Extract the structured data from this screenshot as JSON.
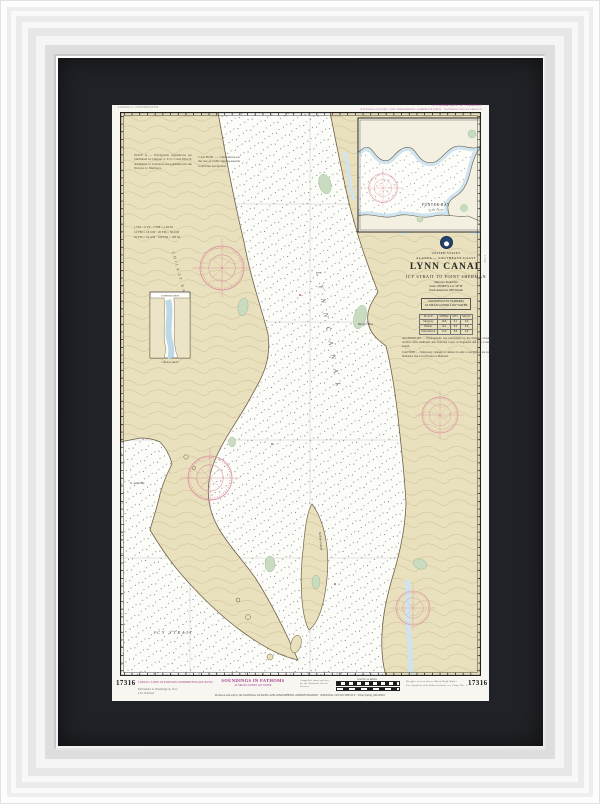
{
  "artwork": {
    "kind": "Framed NOAA nautical chart",
    "colors": {
      "mat": "#212227",
      "paper": "#f7f6f0",
      "land": "#e9e0bd",
      "water": "#fcfcf9",
      "shore_green": "#c9dcc0",
      "glacier_blue": "#cfe4ee",
      "compass_rose_pink": "#d9919f",
      "magenta": "#a7398f"
    }
  },
  "margins": {
    "top_left_note": "LORAN-C OVERPRINTED",
    "top_right_line1": "U.S. DEPARTMENT OF COMMERCE",
    "top_right_line2": "NATIONAL OCEANIC AND ATMOSPHERIC ADMINISTRATION · NATIONAL OCEAN SERVICE",
    "chart_number_left": "17316",
    "chart_number_right": "17316",
    "side_number": "17316",
    "bottom_left_magenta": "LORAN-C LINES OF POSITION OVERPRINTED (SEE NOTE)",
    "bottom_left_sub1": "Published at Washington, D.C.",
    "bottom_left_sub2": "21st Edition",
    "soundings_label": "SOUNDINGS IN FATHOMS",
    "soundings_sub": "AT MEAN LOWER LOW WATER",
    "production_cluster": "Compiled from surveys by the National Ocean Service",
    "scale_caption": "NAUTICAL MILES",
    "right_tiny1": "Heights in feet above Mean High Water",
    "right_tiny2": "For Symbols and Abbreviations see Chart No. 1",
    "bottom_long_note": "Produced and sold by the NATIONAL OCEANIC AND ATMOSPHERIC ADMINISTRATION · NATIONAL OCEAN SERVICE · Silver Spring, MD 20910"
  },
  "title_block": {
    "country": "UNITED STATES",
    "region": "ALASKA — SOUTHEAST COAST",
    "title": "LYNN CANAL",
    "subtitle": "ICY STRAIT TO POINT SHERMAN",
    "projection": "Mercator Projection",
    "scale": "Scale 1:80,000 at Lat. 58°30'",
    "datum": "North American 1983 Datum",
    "soundings1": "SOUNDINGS IN FATHOMS",
    "soundings2": "AT MEAN LOWER LOW WATER",
    "table": {
      "headers": [
        "PLACE",
        "MHHW",
        "MTL",
        "MLLW"
      ],
      "rows": [
        [
          "Skagway",
          "16.8",
          "9.1",
          "0.0"
        ],
        [
          "Haines",
          "16.4",
          "8.9",
          "0.0"
        ],
        [
          "Eldred Rock",
          "15.9",
          "8.6",
          "0.0"
        ]
      ]
    },
    "note1": "AUTHORITIES — Hydrography and topography by the National Ocean Service, with additional data from the Corps of Engineers and U.S. Coast Guard.",
    "note2": "CAUTION — Temporary changes or defects in aids to navigation are not indicated. See Local Notice to Mariners."
  },
  "land_notes": {
    "note_a": "NOTE A — Navigation regulations are published in Chapter 2, U.S. Coast Pilot 8. Additions or revisions are published in the Notices to Mariners.",
    "note_b": "CAUTION — Limitations on the use of radio signals as aids to marine navigation.",
    "conversion": "1 FM = 6 FT · 1 FM = 1.83 M\n10 FM = 18.3 M · 20 FM = 36.6 M\n50 FM = 91.4 M · 100 FM = 183 M"
  },
  "insets": {
    "funter": {
      "label": "FUNTER BAY",
      "sublabel": "SCALE 1:20,000"
    },
    "continuation": {
      "title": "CONTINUATION",
      "caption": "CHILKAT INLET"
    }
  },
  "map_labels": [
    {
      "text": "L Y N N   C A N A L"
    },
    {
      "text": "CHILKAT  RANGE"
    },
    {
      "text": "Berners Bay"
    },
    {
      "text": "Sullivan Island"
    },
    {
      "text": "ICY  STRAIT"
    },
    {
      "text": "St. James Bay"
    }
  ]
}
